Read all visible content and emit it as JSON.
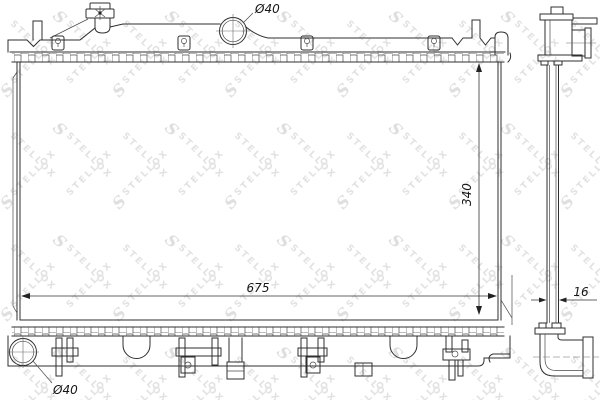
{
  "drawing": {
    "brand": "STELLOX",
    "watermark": {
      "logo": "S",
      "text": "STELLOX",
      "color": "#e2e2e2"
    },
    "line_color": "#2f2f2f",
    "dimensions": {
      "top_inlet_diameter": "Ø40",
      "core_width": "675",
      "core_height": "340",
      "core_thickness": "16",
      "bottom_outlet_diameter": "Ø40"
    }
  }
}
